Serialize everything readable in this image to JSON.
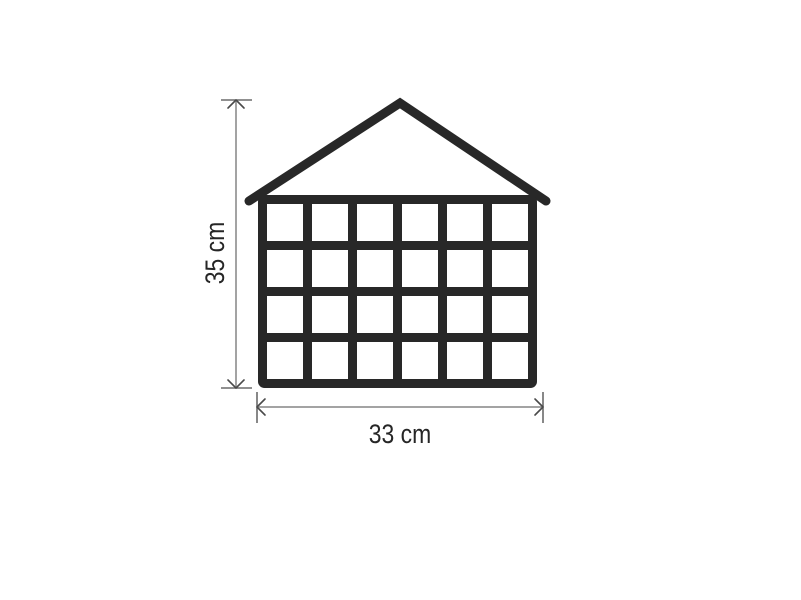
{
  "canvas": {
    "width_px": 801,
    "height_px": 600,
    "background": "#ffffff"
  },
  "diagram": {
    "kind": "product-dimension-drawing",
    "subject": "house-shaped-advent-calendar-window-grid",
    "grid": {
      "columns": 6,
      "rows": 4,
      "cells": 24
    },
    "dimensions": {
      "height": {
        "label": "35 cm"
      },
      "width": {
        "label": "33 cm"
      }
    },
    "colors": {
      "outline": "#282828",
      "dimension_line": "#a3a3a3",
      "dimension_cap": "#6b6b6b",
      "dimension_arrow": "#4a4a4a",
      "label_text": "#262626",
      "background": "#ffffff"
    }
  }
}
